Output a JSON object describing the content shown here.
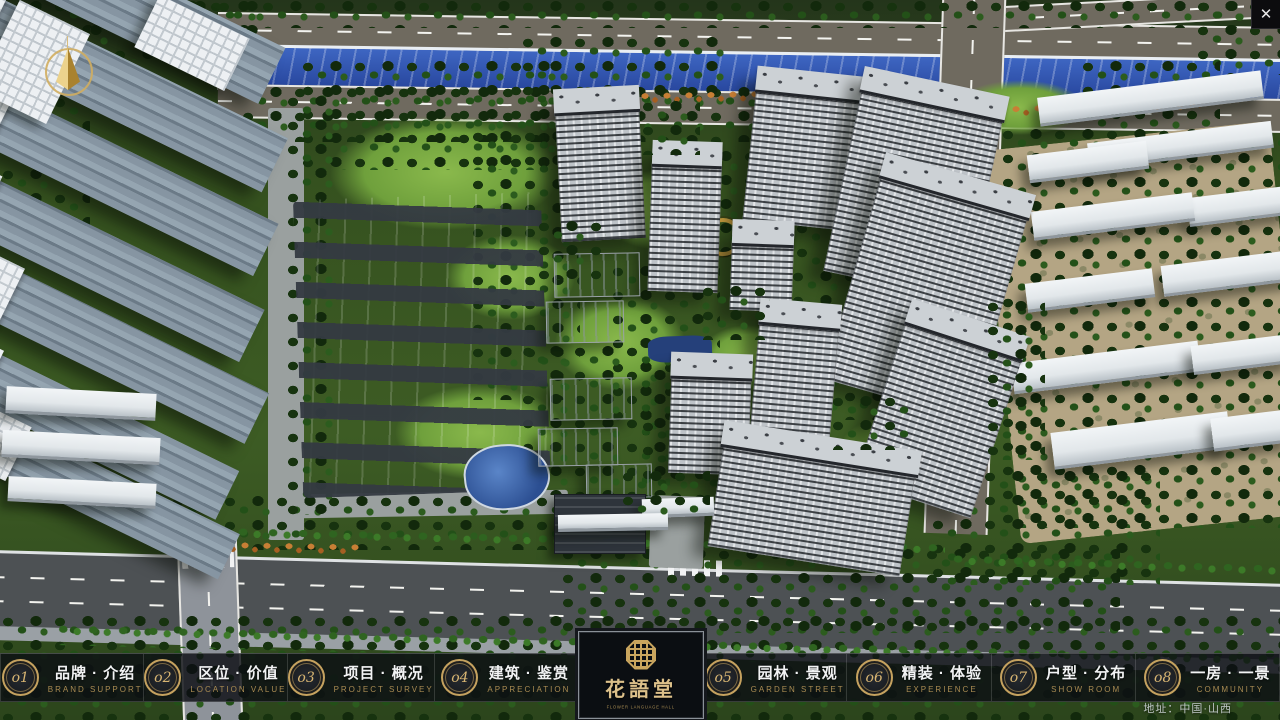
{
  "window": {
    "close_label": "✕"
  },
  "colors": {
    "gold": "#c9a55e",
    "bar_bg": "rgba(12,15,19,0.82)",
    "river_blue": "#2f55b0"
  },
  "nav": {
    "items": [
      {
        "num": "o1",
        "zh": "品牌 · 介绍",
        "en": "BRAND SUPPORT"
      },
      {
        "num": "o2",
        "zh": "区位 · 价值",
        "en": "LOCATION VALUE"
      },
      {
        "num": "o3",
        "zh": "项目 · 概况",
        "en": "PROJECT SURVEY"
      },
      {
        "num": "o4",
        "zh": "建筑 · 鉴赏",
        "en": "APPRECIATION"
      },
      {
        "num": "o5",
        "zh": "园林 · 景观",
        "en": "GARDEN STREET"
      },
      {
        "num": "o6",
        "zh": "精装 · 体验",
        "en": "EXPERIENCE"
      },
      {
        "num": "o7",
        "zh": "户型 · 分布",
        "en": "SHOW ROOM"
      },
      {
        "num": "o8",
        "zh": "一房 · 一景",
        "en": "COMMUNITY"
      }
    ]
  },
  "logo": {
    "title": "花語堂",
    "subtitle": "FLOWER LANGUAGE HALL"
  },
  "footer": {
    "address": "地址：中国·山西"
  },
  "scene": {
    "items": [
      {
        "cls": "tan",
        "x": 1000,
        "y": 135,
        "w": 290,
        "h": 395,
        "r": -6
      },
      {
        "cls": "path",
        "x": 268,
        "y": 108,
        "w": 36,
        "h": 432
      },
      {
        "cls": "path",
        "x": 300,
        "y": 492,
        "w": 268,
        "h": 24,
        "r": -1
      },
      {
        "cls": "lawn",
        "x": 330,
        "y": 115,
        "w": 230,
        "h": 115
      },
      {
        "cls": "lawn",
        "x": 600,
        "y": 170,
        "w": 120,
        "h": 80
      },
      {
        "cls": "lawn",
        "x": 555,
        "y": 295,
        "w": 130,
        "h": 95
      },
      {
        "cls": "lawn",
        "x": 395,
        "y": 385,
        "w": 170,
        "h": 95
      },
      {
        "cls": "lawn",
        "x": 835,
        "y": 415,
        "w": 130,
        "h": 85
      },
      {
        "cls": "lawn",
        "x": 445,
        "y": 235,
        "w": 130,
        "h": 85
      },
      {
        "cls": "lawn",
        "x": 955,
        "y": 80,
        "w": 130,
        "h": 55
      },
      {
        "cls": "lawn",
        "x": 700,
        "y": 325,
        "w": 95,
        "h": 65
      },
      {
        "cls": "trees",
        "x": 0,
        "y": 0,
        "w": 1280,
        "h": 28
      },
      {
        "cls": "trees",
        "x": 0,
        "y": 0,
        "w": 90,
        "h": 230
      },
      {
        "cls": "trees",
        "x": 60,
        "y": 0,
        "w": 210,
        "h": 60
      },
      {
        "cls": "trees",
        "x": 240,
        "y": 86,
        "w": 720,
        "h": 56
      },
      {
        "cls": "trees",
        "x": 300,
        "y": 60,
        "w": 260,
        "h": 110
      },
      {
        "cls": "trees",
        "x": 520,
        "y": 36,
        "w": 210,
        "h": 72
      },
      {
        "cls": "trees",
        "x": 470,
        "y": 130,
        "w": 110,
        "h": 270
      },
      {
        "cls": "trees",
        "x": 610,
        "y": 265,
        "w": 110,
        "h": 170
      },
      {
        "cls": "trees",
        "x": 520,
        "y": 345,
        "w": 150,
        "h": 150
      },
      {
        "cls": "trees",
        "x": 640,
        "y": 420,
        "w": 120,
        "h": 110
      },
      {
        "cls": "trees",
        "x": 690,
        "y": 150,
        "w": 130,
        "h": 120
      },
      {
        "cls": "trees",
        "x": 790,
        "y": 270,
        "w": 110,
        "h": 150
      },
      {
        "cls": "trees",
        "x": 1000,
        "y": 128,
        "w": 290,
        "h": 400
      },
      {
        "cls": "trees",
        "x": 1195,
        "y": 0,
        "w": 90,
        "h": 75
      },
      {
        "cls": "trees",
        "x": 170,
        "y": 495,
        "w": 430,
        "h": 55
      },
      {
        "cls": "trees",
        "x": 0,
        "y": 615,
        "w": 1290,
        "h": 110
      },
      {
        "cls": "trees",
        "x": 560,
        "y": 548,
        "w": 560,
        "h": 85
      },
      {
        "cls": "trees",
        "x": 930,
        "y": 470,
        "w": 230,
        "h": 115
      },
      {
        "cls": "trees",
        "x": 285,
        "y": 95,
        "w": 55,
        "h": 420
      },
      {
        "cls": "trees",
        "x": 1080,
        "y": 60,
        "w": 140,
        "h": 70
      },
      {
        "cls": "orange",
        "x": 595,
        "y": 88,
        "w": 340,
        "h": 16,
        "r": -1
      },
      {
        "cls": "orange",
        "x": 1010,
        "y": 100,
        "w": 190,
        "h": 13,
        "r": -2
      },
      {
        "cls": "orange",
        "x": 195,
        "y": 540,
        "w": 165,
        "h": 13,
        "r": 1
      },
      {
        "cls": "treerow",
        "x": 235,
        "y": 532,
        "w": 710,
        "h": 20,
        "r": 1.3
      },
      {
        "cls": "treerow",
        "x": 950,
        "y": 556,
        "w": 330,
        "h": 22,
        "r": 1.8
      },
      {
        "cls": "treerow",
        "x": 55,
        "y": 636,
        "w": 1225,
        "h": 24,
        "r": 1.4
      },
      {
        "cls": "court",
        "x": 298,
        "y": 196,
        "w": 248,
        "h": 298,
        "r": -2
      },
      {
        "cls": "pool",
        "x": 464,
        "y": 444,
        "w": 82,
        "h": 62,
        "r": -6
      },
      {
        "cls": "pool2",
        "x": 648,
        "y": 336,
        "w": 64,
        "h": 26,
        "r": -2
      },
      {
        "cls": "goldstrip",
        "x": 582,
        "y": 224,
        "w": 58,
        "h": 14,
        "r": -2
      },
      {
        "cls": "goldring",
        "x": 704,
        "y": 218,
        "w": 30,
        "h": 30
      },
      {
        "cls": "lt",
        "cap": 1,
        "x": -70,
        "y": -34,
        "w": 360,
        "h": 62,
        "r": 26
      },
      {
        "cls": "lt",
        "cap": 1,
        "x": -86,
        "y": 52,
        "w": 380,
        "h": 60,
        "r": 26
      },
      {
        "cls": "lt",
        "cap": 1,
        "x": -76,
        "y": 142,
        "w": 360,
        "h": 58,
        "r": 26
      },
      {
        "cls": "lt",
        "cap": 1,
        "x": -90,
        "y": 228,
        "w": 360,
        "h": 58,
        "r": 26
      },
      {
        "cls": "lt",
        "cap": 1,
        "x": -66,
        "y": 316,
        "w": 340,
        "h": 56,
        "r": 26
      },
      {
        "cls": "lt",
        "cap": 1,
        "x": -86,
        "y": 396,
        "w": 330,
        "h": 54,
        "r": 26
      },
      {
        "cls": "lt",
        "cap": 1,
        "x": -56,
        "y": 466,
        "w": 300,
        "h": 50,
        "r": 26
      },
      {
        "cls": "castle",
        "x": -6,
        "y": 12,
        "w": 78,
        "h": 100,
        "r": 26
      },
      {
        "cls": "castle",
        "x": 142,
        "y": 14,
        "w": 100,
        "h": 58,
        "r": 26
      },
      {
        "cls": "rs",
        "x": 6,
        "y": 390,
        "w": 150,
        "h": 24,
        "r": 3
      },
      {
        "cls": "rs",
        "x": 2,
        "y": 434,
        "w": 158,
        "h": 24,
        "r": 3
      },
      {
        "cls": "rs",
        "x": 8,
        "y": 480,
        "w": 148,
        "h": 22,
        "r": 3
      },
      {
        "cls": "rs",
        "x": 1038,
        "y": 84,
        "w": 225,
        "h": 26,
        "r": -7
      },
      {
        "cls": "rs",
        "x": 1088,
        "y": 132,
        "w": 185,
        "h": 24,
        "r": -7
      },
      {
        "cls": "rs",
        "x": 1028,
        "y": 148,
        "w": 120,
        "h": 25,
        "r": -7
      },
      {
        "cls": "rs",
        "x": 1188,
        "y": 192,
        "w": 100,
        "h": 26,
        "r": -7
      },
      {
        "cls": "rs",
        "x": 1032,
        "y": 202,
        "w": 162,
        "h": 26,
        "r": -7
      },
      {
        "cls": "rs",
        "x": 1162,
        "y": 258,
        "w": 132,
        "h": 28,
        "r": -7
      },
      {
        "cls": "rs",
        "x": 1026,
        "y": 276,
        "w": 128,
        "h": 26,
        "r": -7
      },
      {
        "cls": "rs",
        "x": 1012,
        "y": 352,
        "w": 188,
        "h": 28,
        "r": -7
      },
      {
        "cls": "rs",
        "x": 1192,
        "y": 340,
        "w": 100,
        "h": 26,
        "r": -7
      },
      {
        "cls": "rs",
        "x": 1052,
        "y": 422,
        "w": 178,
        "h": 34,
        "r": -7
      },
      {
        "cls": "rs",
        "x": 1212,
        "y": 414,
        "w": 78,
        "h": 30,
        "r": -7
      },
      {
        "cls": "path",
        "x": 650,
        "y": 496,
        "w": 54,
        "h": 72,
        "r": 2
      },
      {
        "cls": "ct",
        "roof": 1,
        "x": 558,
        "y": 92,
        "w": 82,
        "h": 146,
        "r": -3
      },
      {
        "cls": "ct",
        "roof": 1,
        "x": 650,
        "y": 146,
        "w": 68,
        "h": 144,
        "r": 2
      },
      {
        "cls": "ct",
        "roof": 1,
        "x": 750,
        "y": 76,
        "w": 108,
        "h": 148,
        "r": 6
      },
      {
        "cls": "ct",
        "roof": 1,
        "x": 843,
        "y": 84,
        "w": 142,
        "h": 202,
        "r": 12
      },
      {
        "cls": "ct",
        "roof": 1,
        "x": 852,
        "y": 174,
        "w": 150,
        "h": 228,
        "r": 16
      },
      {
        "cls": "ct",
        "roof": 1,
        "x": 731,
        "y": 225,
        "w": 60,
        "h": 84,
        "r": 2
      },
      {
        "cls": "ct",
        "roof": 1,
        "x": 755,
        "y": 306,
        "w": 78,
        "h": 136,
        "r": 5
      },
      {
        "cls": "ct",
        "roof": 1,
        "x": 880,
        "y": 318,
        "w": 120,
        "h": 184,
        "r": 18
      },
      {
        "cls": "ct",
        "roof": 1,
        "x": 670,
        "y": 358,
        "w": 78,
        "h": 114,
        "r": 2
      },
      {
        "cls": "ct",
        "roof": 1,
        "x": 716,
        "y": 440,
        "w": 192,
        "h": 120,
        "r": 9
      },
      {
        "cls": "wl",
        "x": 554,
        "y": 253,
        "w": 84,
        "h": 42,
        "r": -1
      },
      {
        "cls": "wl",
        "x": 546,
        "y": 301,
        "w": 76,
        "h": 40,
        "r": -1
      },
      {
        "cls": "wl",
        "x": 550,
        "y": 378,
        "w": 80,
        "h": 40,
        "r": -1
      },
      {
        "cls": "wl",
        "x": 538,
        "y": 428,
        "w": 78,
        "h": 36,
        "r": -1
      },
      {
        "cls": "wl",
        "x": 586,
        "y": 464,
        "w": 64,
        "h": 32,
        "r": -1
      },
      {
        "cls": "gate",
        "x": 554,
        "y": 494,
        "w": 90,
        "h": 58
      },
      {
        "cls": "rs",
        "x": 642,
        "y": 498,
        "w": 72,
        "h": 16,
        "r": -2
      },
      {
        "cls": "rs",
        "x": 558,
        "y": 514,
        "w": 110,
        "h": 14,
        "r": -1
      },
      {
        "cls": "trees",
        "x": 536,
        "y": 220,
        "w": 70,
        "h": 60
      },
      {
        "cls": "trees",
        "x": 700,
        "y": 285,
        "w": 70,
        "h": 55
      },
      {
        "cls": "trees",
        "x": 640,
        "y": 100,
        "w": 60,
        "h": 55
      },
      {
        "cls": "trees",
        "x": 830,
        "y": 395,
        "w": 80,
        "h": 55
      },
      {
        "cls": "trees",
        "x": 620,
        "y": 470,
        "w": 90,
        "h": 45
      },
      {
        "cls": "trees",
        "x": 985,
        "y": 300,
        "w": 60,
        "h": 160
      }
    ]
  }
}
